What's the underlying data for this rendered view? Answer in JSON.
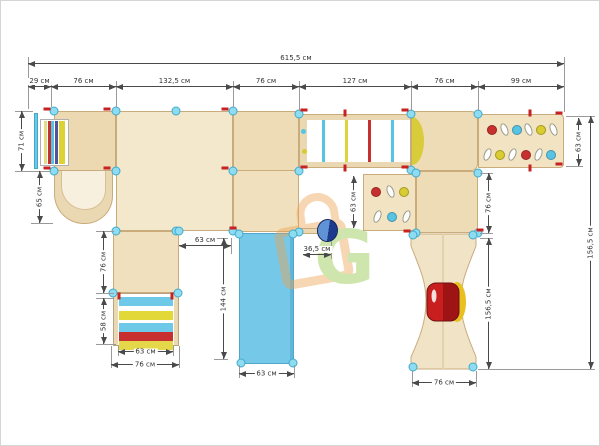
{
  "drawing": {
    "kind": "playground-complex-top-view-plan",
    "units_label": "см",
    "watermark_letter": "G"
  },
  "dims": {
    "total_width": "615,5 см",
    "seg_1": "29 см",
    "seg_2": "76 см",
    "seg_3": "132,5 см",
    "seg_4": "76 см",
    "seg_5": "127 см",
    "seg_6": "76 см",
    "seg_7": "99 см",
    "entry_ladder_height": "71 см",
    "tunnel_depth": "65 см",
    "left_column_depth": "76 см",
    "steps_depth": "58 см",
    "steps_inner_width": "63 см",
    "steps_outer_width": "76 см",
    "slide_gap": "63 см",
    "slide_length": "144 см",
    "slide_width": "63 см",
    "bag_offset": "36,5 см",
    "climb_panel_depth": "63 см",
    "right_column_depth": "76 см",
    "ramp_length": "156,5 см",
    "ramp_width": "76 см",
    "climb_board_depth": "63 см",
    "right_total_depth": "156,5 см"
  },
  "colors": {
    "wood_light": "#f3e7cc",
    "wood_mid": "#eedcb6",
    "wood_dark": "#ead8b2",
    "wood_edge": "#c9ab7c",
    "slide_blue": "#76c8e8",
    "connector_cyan": "#8edcf2",
    "marker_red": "#c62222",
    "seat_red": "#c81e1e",
    "seat_yellow": "#e8c020",
    "knob_blue": "#2a4a9c",
    "watermark_orange": "#eea24c",
    "watermark_green": "#8cc63f"
  },
  "elements": {
    "bridge_rungs": [
      "#58c4e4",
      "#ddd33a",
      "#c83030",
      "#58c4e4"
    ],
    "bridge_post_holds": [
      "#58c4e4",
      "#d8cc30"
    ],
    "entry_ladder_rungs": [
      "#e6dc86",
      "#c83030",
      "#58c4e4",
      "#5252a2",
      "#dcd234"
    ],
    "step_bands": [
      "#6ec8e8",
      "#e2d838",
      "#6ec8e8",
      "#c83030",
      "#e4d84a"
    ],
    "board_holds_row1": [
      {
        "type": "dot",
        "color": "#c83030"
      },
      {
        "type": "oval"
      },
      {
        "type": "dot",
        "color": "#58c4e4"
      },
      {
        "type": "oval"
      },
      {
        "type": "dot",
        "color": "#d8cc30"
      },
      {
        "type": "oval"
      }
    ],
    "board_holds_row2": [
      {
        "type": "oval"
      },
      {
        "type": "dot",
        "color": "#d8cc30"
      },
      {
        "type": "oval"
      },
      {
        "type": "dot",
        "color": "#c83030"
      },
      {
        "type": "oval"
      },
      {
        "type": "dot",
        "color": "#58c4e4"
      }
    ],
    "panel_holds_row1": [
      {
        "type": "dot",
        "color": "#c83030"
      },
      {
        "type": "oval"
      },
      {
        "type": "dot",
        "color": "#d8cc30"
      }
    ],
    "panel_holds_row2": [
      {
        "type": "oval"
      },
      {
        "type": "dot",
        "color": "#58c4e4"
      },
      {
        "type": "oval"
      }
    ]
  }
}
